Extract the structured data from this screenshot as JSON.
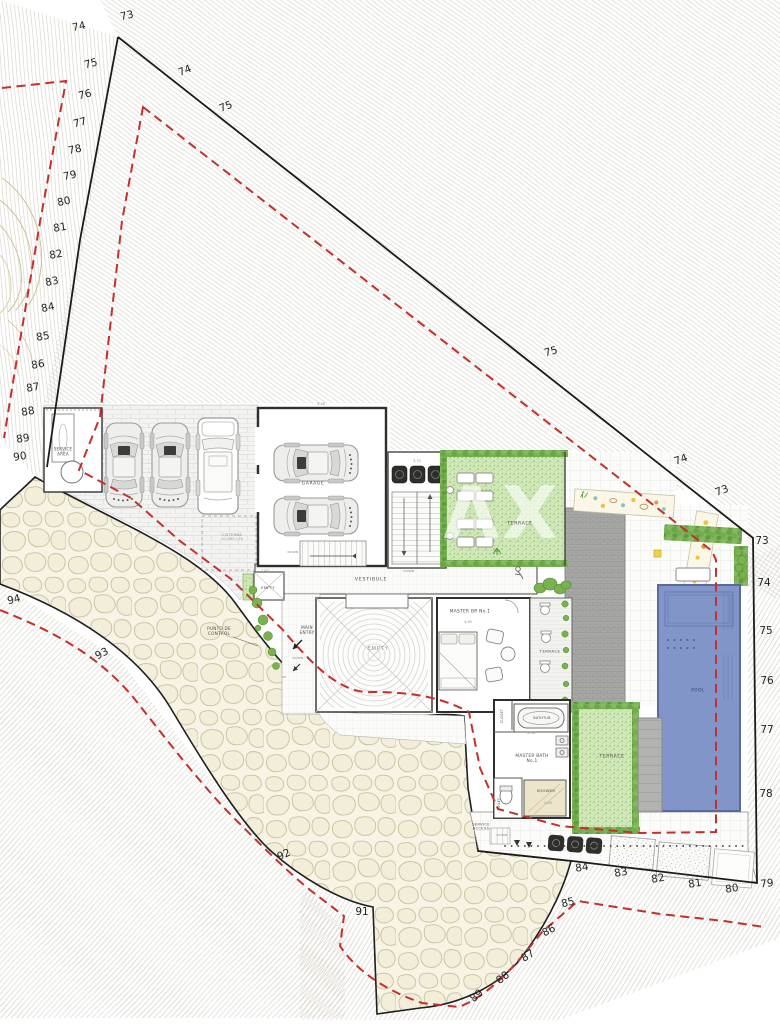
{
  "watermark": "AX",
  "colors": {
    "boundary": "#1c1c1c",
    "setback_red": "#c62f2a",
    "contour_line": "#d9d5cb",
    "stone_fill": "#f7f4e6",
    "terrace_green": "#cfe7b6",
    "hedge_green": "#6aa547",
    "pool_blue": "#8295c9",
    "deck_gray": "#a6a6a4",
    "planter_dark": "#2e2e2e"
  },
  "elevations": [
    {
      "t": "73",
      "x": 127,
      "y": 16,
      "r": -12
    },
    {
      "t": "74",
      "x": 79,
      "y": 27,
      "r": -12
    },
    {
      "t": "75",
      "x": 91,
      "y": 64,
      "r": -14
    },
    {
      "t": "76",
      "x": 85,
      "y": 95,
      "r": -14
    },
    {
      "t": "77",
      "x": 80,
      "y": 123,
      "r": -14
    },
    {
      "t": "78",
      "x": 75,
      "y": 150,
      "r": -12
    },
    {
      "t": "79",
      "x": 70,
      "y": 176,
      "r": -12
    },
    {
      "t": "80",
      "x": 64,
      "y": 202,
      "r": -12
    },
    {
      "t": "81",
      "x": 60,
      "y": 228,
      "r": -10
    },
    {
      "t": "82",
      "x": 56,
      "y": 255,
      "r": -10
    },
    {
      "t": "83",
      "x": 52,
      "y": 282,
      "r": -12
    },
    {
      "t": "84",
      "x": 48,
      "y": 308,
      "r": -12
    },
    {
      "t": "85",
      "x": 43,
      "y": 337,
      "r": -10
    },
    {
      "t": "86",
      "x": 38,
      "y": 365,
      "r": -10
    },
    {
      "t": "87",
      "x": 33,
      "y": 388,
      "r": -10
    },
    {
      "t": "88",
      "x": 28,
      "y": 412,
      "r": -10
    },
    {
      "t": "89",
      "x": 23,
      "y": 439,
      "r": -8
    },
    {
      "t": "90",
      "x": 20,
      "y": 457,
      "r": -8
    },
    {
      "t": "74",
      "x": 185,
      "y": 71,
      "r": -22
    },
    {
      "t": "75",
      "x": 226,
      "y": 107,
      "r": -22
    },
    {
      "t": "75",
      "x": 551,
      "y": 352,
      "r": -16
    },
    {
      "t": "74",
      "x": 681,
      "y": 460,
      "r": -20
    },
    {
      "t": "73",
      "x": 722,
      "y": 491,
      "r": -20
    },
    {
      "t": "73",
      "x": 762,
      "y": 541,
      "r": 0
    },
    {
      "t": "74",
      "x": 764,
      "y": 583,
      "r": 0
    },
    {
      "t": "75",
      "x": 766,
      "y": 631,
      "r": 0
    },
    {
      "t": "76",
      "x": 767,
      "y": 681,
      "r": 0
    },
    {
      "t": "77",
      "x": 767,
      "y": 730,
      "r": 0
    },
    {
      "t": "78",
      "x": 766,
      "y": 794,
      "r": 0
    },
    {
      "t": "79",
      "x": 767,
      "y": 884,
      "r": -6
    },
    {
      "t": "80",
      "x": 732,
      "y": 889,
      "r": -8
    },
    {
      "t": "81",
      "x": 695,
      "y": 884,
      "r": -10
    },
    {
      "t": "82",
      "x": 658,
      "y": 879,
      "r": -10
    },
    {
      "t": "83",
      "x": 621,
      "y": 873,
      "r": -10
    },
    {
      "t": "84",
      "x": 582,
      "y": 868,
      "r": -8
    },
    {
      "t": "85",
      "x": 568,
      "y": 903,
      "r": -14
    },
    {
      "t": "86",
      "x": 549,
      "y": 931,
      "r": -28
    },
    {
      "t": "87",
      "x": 528,
      "y": 956,
      "r": -34
    },
    {
      "t": "88",
      "x": 503,
      "y": 978,
      "r": -38
    },
    {
      "t": "89",
      "x": 477,
      "y": 996,
      "r": -42
    },
    {
      "t": "91",
      "x": 362,
      "y": 912,
      "r": 0
    },
    {
      "t": "92",
      "x": 284,
      "y": 855,
      "r": -24
    },
    {
      "t": "93",
      "x": 102,
      "y": 654,
      "r": -28
    },
    {
      "t": "94",
      "x": 14,
      "y": 600,
      "r": -14
    }
  ],
  "labels": [
    {
      "t": "SERVICE\nAREA",
      "x": 63,
      "y": 452,
      "fs": 4,
      "n": "label-service-area"
    },
    {
      "t": "CISTERNA\n10,000 LTS",
      "x": 232,
      "y": 537,
      "fs": 3.6,
      "c": "#8a8a8a",
      "n": "label-cisterna"
    },
    {
      "t": "GARAGE",
      "x": 313,
      "y": 484,
      "fs": 4.6,
      "ls": 0.6,
      "n": "label-garage"
    },
    {
      "t": "VESTIBULE",
      "x": 371,
      "y": 580,
      "fs": 4.6,
      "ls": 0.8,
      "n": "label-vestibule"
    },
    {
      "t": "EMPTY",
      "x": 268,
      "y": 588,
      "fs": 3.8,
      "n": "label-empty-room"
    },
    {
      "t": "EMPTY",
      "x": 378,
      "y": 649,
      "fs": 5.2,
      "c": "#979797",
      "ls": 0.8,
      "n": "label-empty-courtyard"
    },
    {
      "t": "MASTER BR  No.1",
      "x": 470,
      "y": 612,
      "fs": 4.4,
      "n": "label-master-br"
    },
    {
      "t": "TERRACE",
      "x": 520,
      "y": 524,
      "fs": 4.6,
      "ls": 0.6,
      "n": "label-terrace-upper"
    },
    {
      "t": "TERRACE",
      "x": 550,
      "y": 652,
      "fs": 3.9,
      "ls": 0.4,
      "n": "label-terrace-br"
    },
    {
      "t": "TERRACE",
      "x": 612,
      "y": 757,
      "fs": 4.6,
      "ls": 0.6,
      "n": "label-terrace-bath"
    },
    {
      "t": "MASTER BATH\nNo.1",
      "x": 532,
      "y": 759,
      "fs": 4.3,
      "n": "label-master-bath"
    },
    {
      "t": "BATHTUB",
      "x": 542,
      "y": 719,
      "fs": 3.3,
      "n": "label-bathtub"
    },
    {
      "t": "SHOWER",
      "x": 546,
      "y": 791,
      "fs": 3.8,
      "n": "label-shower"
    },
    {
      "t": "CLOSET",
      "x": 503,
      "y": 716,
      "fs": 3.3,
      "r": -90,
      "n": "label-closet"
    },
    {
      "t": "TOILET",
      "x": 500,
      "y": 804,
      "fs": 3.1,
      "r": -90,
      "n": "label-toilet"
    },
    {
      "t": "POOL",
      "x": 698,
      "y": 691,
      "fs": 4.2,
      "c": "#2e3f66",
      "ls": 0.5,
      "n": "label-pool"
    },
    {
      "t": "MAIN\nENTRY",
      "x": 307,
      "y": 631,
      "fs": 4.2,
      "n": "label-main-entry"
    },
    {
      "t": "PUNTO DE\nCONTROL",
      "x": 219,
      "y": 632,
      "fs": 4.2,
      "n": "label-punto-de-control"
    },
    {
      "t": "SERVICE\nACCESS",
      "x": 481,
      "y": 827,
      "fs": 3.8,
      "n": "label-service-access"
    },
    {
      "t": "DOWN",
      "x": 293,
      "y": 553,
      "fs": 3,
      "c": "#777777",
      "n": "label-down"
    },
    {
      "t": "DOWN",
      "x": 409,
      "y": 572,
      "fs": 3,
      "c": "#777777",
      "n": "label-down"
    },
    {
      "t": "DOWN",
      "x": 298,
      "y": 659,
      "fs": 3,
      "c": "#777777",
      "n": "label-down"
    },
    {
      "t": "UP",
      "x": 284,
      "y": 678,
      "fs": 3,
      "c": "#777777",
      "n": "label-up"
    },
    {
      "t": "DOWN",
      "x": 502,
      "y": 836,
      "fs": 3,
      "c": "#777777",
      "n": "label-down"
    }
  ],
  "dims": [
    {
      "t": "6.48",
      "x": 321,
      "y": 404
    },
    {
      "t": "3.70",
      "x": 417,
      "y": 461
    },
    {
      "t": "4.94",
      "x": 468,
      "y": 622
    },
    {
      "t": "1.42",
      "x": 265,
      "y": 571
    },
    {
      "t": "2.50",
      "x": 531,
      "y": 733
    },
    {
      "t": "2.00",
      "x": 548,
      "y": 803
    }
  ]
}
